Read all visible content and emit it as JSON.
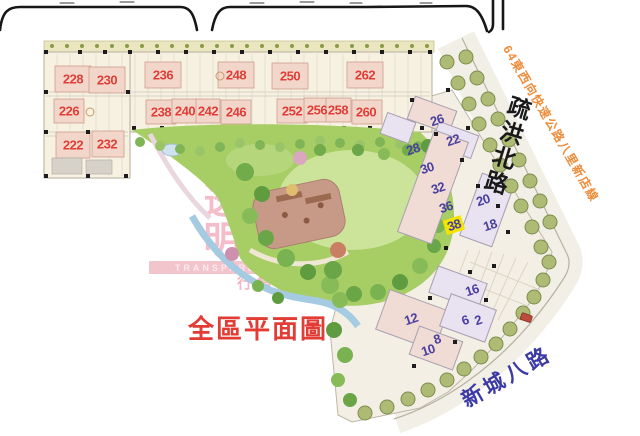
{
  "title": {
    "text": "全區平面圖"
  },
  "roads": {
    "north": "疏洪北路",
    "south": "新城八路",
    "expressway": "64東西向快速公路八里新店線"
  },
  "watermark": {
    "main": "透明",
    "band": "TRANSPARENT",
    "sub": "行情通買賣價"
  },
  "plan": {
    "red_units": [
      "228",
      "230",
      "236",
      "248",
      "250",
      "262",
      "226",
      "238",
      "240",
      "242",
      "246",
      "252",
      "256",
      "258",
      "260",
      "222",
      "232"
    ],
    "blue_units": [
      "26",
      "22",
      "28",
      "30",
      "32",
      "36",
      "38",
      "20",
      "18",
      "16",
      "12",
      "6",
      "2",
      "8",
      "10"
    ],
    "highlighted_unit": "38",
    "colors": {
      "red_label": "#e23b33",
      "blue_label": "#4a3f9f",
      "highlight_bg": "#f5e300",
      "title_red": "#e23c35",
      "north_road_text": "#191919",
      "south_road_text": "#3c3aa5",
      "expressway_text": "#ed8c3a",
      "watermark_pink": "#f4bdc9",
      "lawn_green": "#a7cd65",
      "water_blue": "#a5cbe2"
    }
  }
}
